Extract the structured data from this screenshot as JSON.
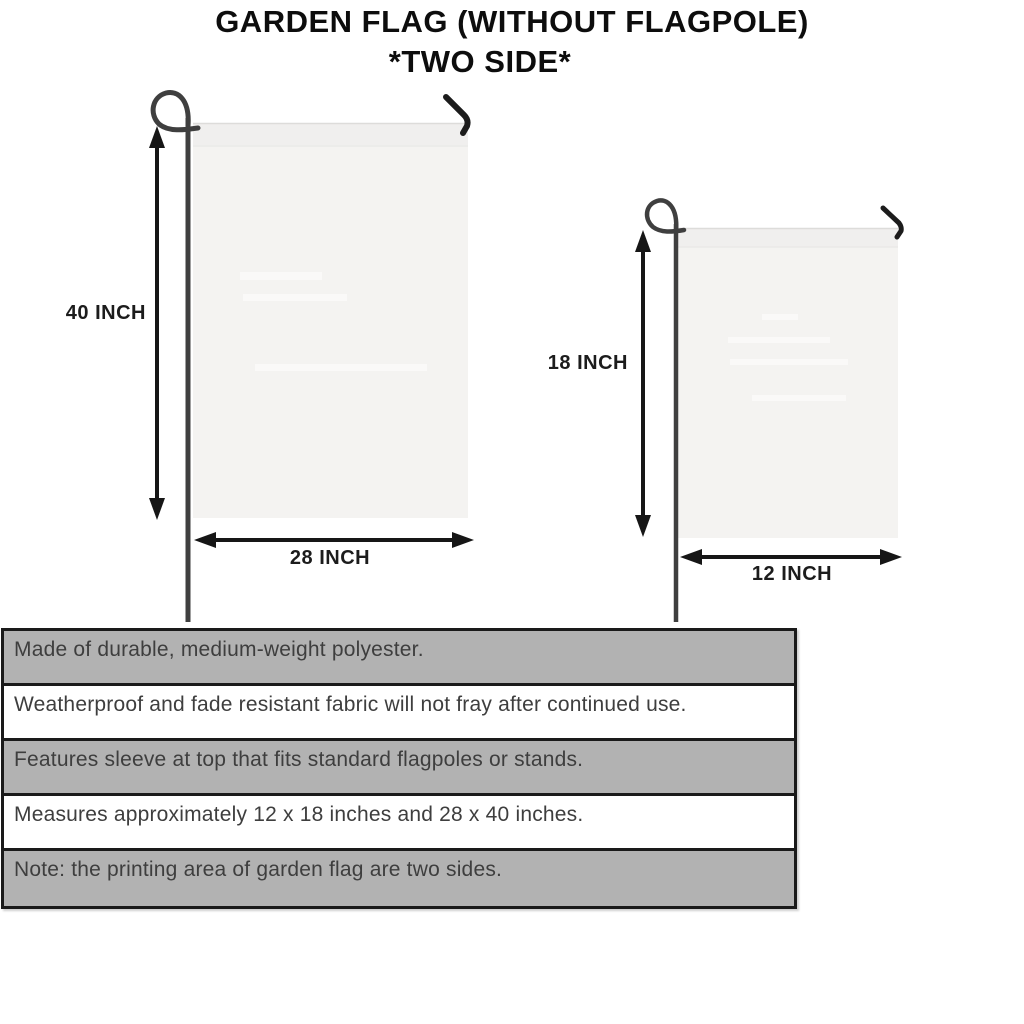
{
  "title": {
    "line1": "GARDEN FLAG (WITHOUT FLAGPOLE)",
    "line2": "*TWO SIDE*"
  },
  "diagram": {
    "large_flag": {
      "name": "large garden flag 28 x 40 inches",
      "height_label": "40 INCH",
      "width_label": "28 INCH"
    },
    "small_flag": {
      "name": "small garden flag 12 x 18 inches",
      "height_label": "18 INCH",
      "width_label": "12 INCH"
    }
  },
  "features": [
    "Made of durable, medium-weight polyester.",
    "Weatherproof and fade resistant fabric will not fray after continued use.",
    "Features sleeve at top that fits standard flagpoles or stands.",
    "Measures approximately 12 x 18 inches and 28 x 40 inches.",
    "Note: the printing area of garden flag are two sides."
  ],
  "colors": {
    "title_text": "#0d0d0d",
    "dimension_arrow": "#161616",
    "dimension_label": "#1c1c1c",
    "flag_fill": "#f4f3f1",
    "flag_sleeve": "#f0efee",
    "pole": "#3f3f3f",
    "table_border": "#1a1a1a",
    "row_gray": "#b2b2b2",
    "row_white": "#ffffff",
    "feature_text": "#3e3e3e",
    "background": "#ffffff"
  }
}
